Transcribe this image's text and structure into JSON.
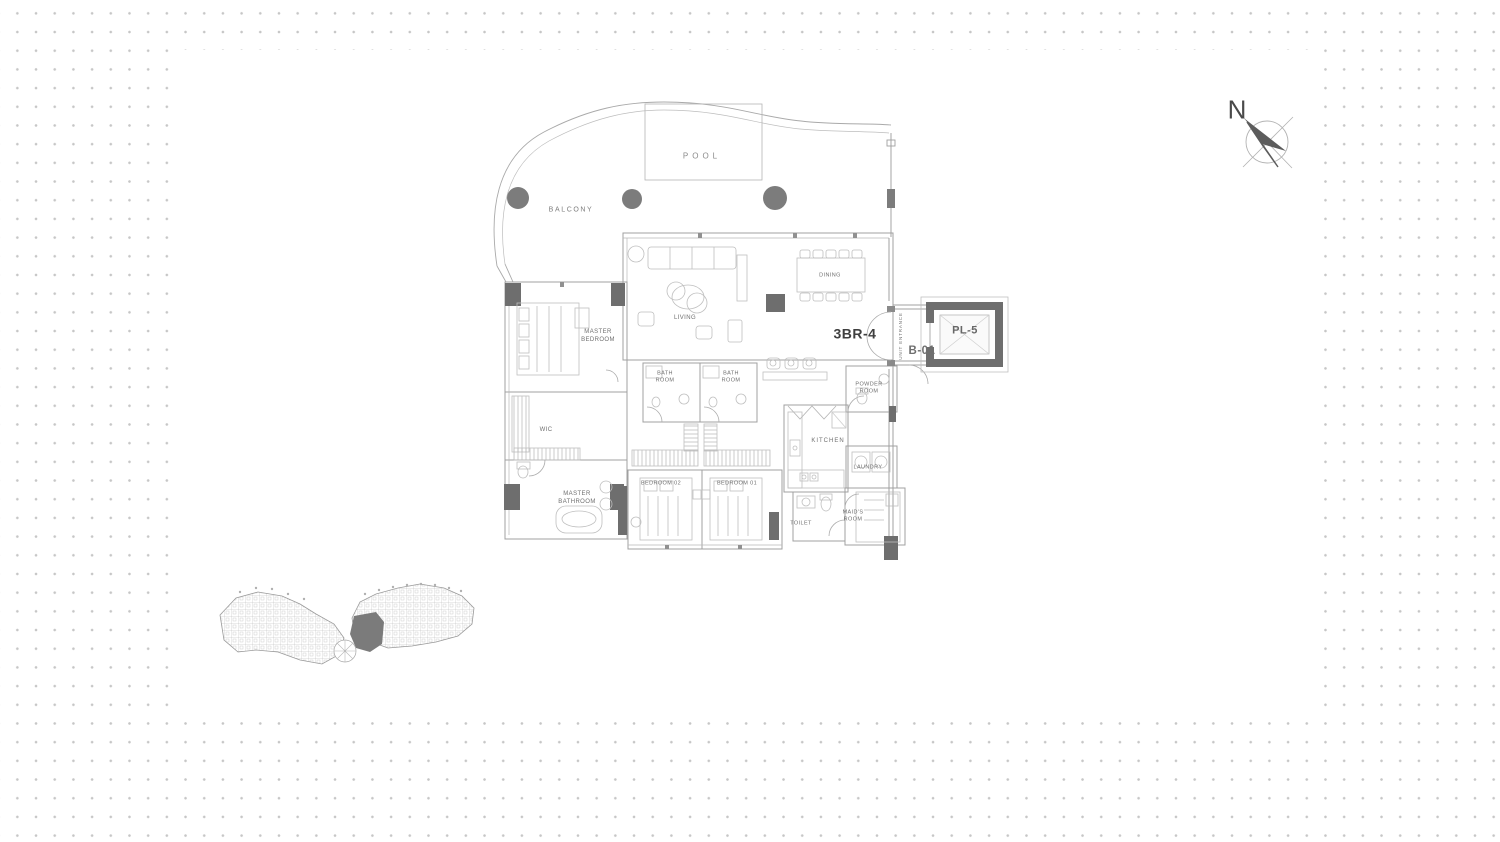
{
  "canvas": {
    "background": "#ffffff",
    "dot_color": "#c6c6c6",
    "line_color": "#a8a8a8",
    "furniture_line_color": "#bfbfbf",
    "dark_wall_color": "#6e6e6e",
    "label_color": "#6f6f6f",
    "unit_label_color": "#3f3f3f"
  },
  "compass": {
    "north": "N"
  },
  "outdoor": {
    "pool": "POOL",
    "balcony": "BALCONY"
  },
  "unit": {
    "type": "3BR-4",
    "entrance": "UNIT ENTRANCE",
    "lobby": "B-01",
    "lift": "PL-5",
    "rooms": {
      "living": "LIVING",
      "dining": "DINING",
      "master_bedroom": "MASTER\nBEDROOM",
      "wic": "WIC",
      "master_bathroom": "MASTER\nBATHROOM",
      "bath_room_a": "BATH\nROOM",
      "bath_room_b": "BATH\nROOM",
      "bedroom_02": "BEDROOM 02",
      "bedroom_01": "BEDROOM 01",
      "kitchen": "KITCHEN",
      "powder_room": "POWDER\nROOM",
      "laundry": "LAUNDRY",
      "toilet": "TOILET",
      "maids_room": "MAID'S\nROOM"
    }
  }
}
